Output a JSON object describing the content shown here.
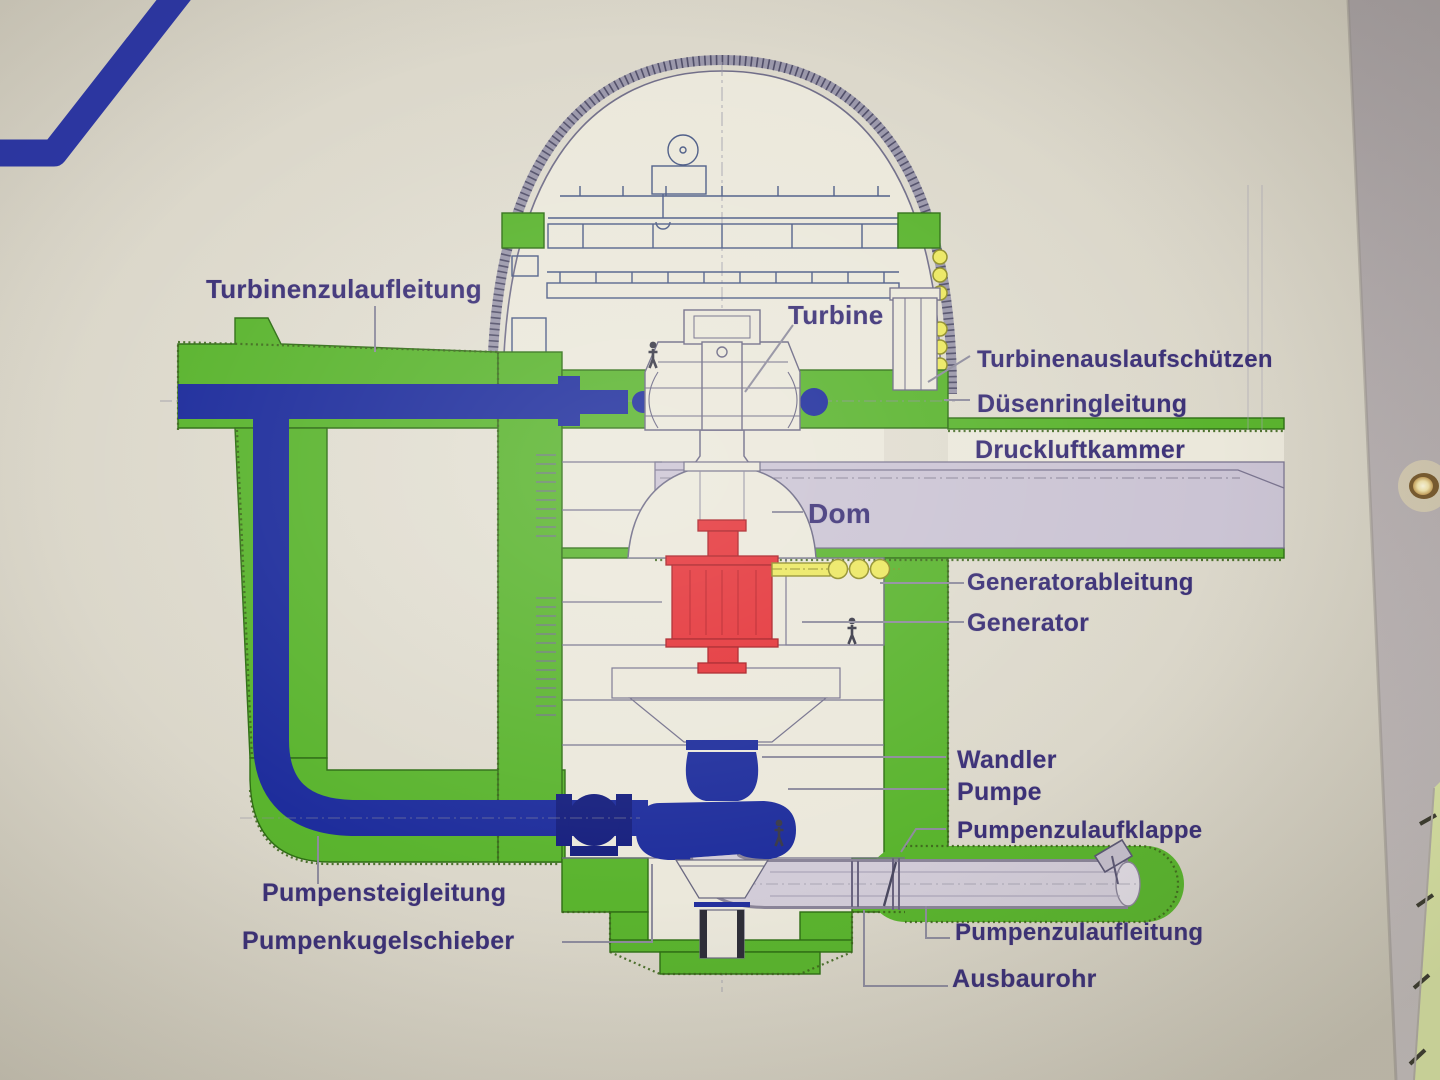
{
  "colors": {
    "wall_beige": "#d9d5c8",
    "drawing_interior": "#ebe8db",
    "concrete_green": "#5ab42e",
    "pipe_blue": "#1e2d9c",
    "wall_stripe_blue": "#2b36a6",
    "generator_red": "#e43338",
    "cable_yellow": "#ece861",
    "air_chamber_lavender": "#cbc4d4",
    "suction_pipe_gray": "#d2ccd8",
    "label_ink": "#3c3177",
    "line_ink": "#6b6884",
    "window_glow": "#dde8a8"
  },
  "labels": [
    {
      "id": "turbinenzulaufleitung",
      "text": "Turbinenzulaufleitung"
    },
    {
      "id": "turbine",
      "text": "Turbine"
    },
    {
      "id": "turbinenauslaufschuetzen",
      "text": "Turbinenauslaufschützen"
    },
    {
      "id": "duesenringleitung",
      "text": "Düsenringleitung"
    },
    {
      "id": "druckluftkammer",
      "text": "Druckluftkammer"
    },
    {
      "id": "dom",
      "text": "Dom"
    },
    {
      "id": "generatorableitung",
      "text": "Generatorableitung"
    },
    {
      "id": "generator",
      "text": "Generator"
    },
    {
      "id": "wandler",
      "text": "Wandler"
    },
    {
      "id": "pumpe",
      "text": "Pumpe"
    },
    {
      "id": "pumpenzulaufklappe",
      "text": "Pumpenzulaufklappe"
    },
    {
      "id": "pumpensteigleitung",
      "text": "Pumpensteigleitung"
    },
    {
      "id": "pumpenkugelschieber",
      "text": "Pumpenkugelschieber"
    },
    {
      "id": "pumpenzulaufleitung",
      "text": "Pumpenzulaufleitung"
    },
    {
      "id": "ausbaurohr",
      "text": "Ausbaurohr"
    }
  ],
  "photo_features": {
    "person_figures": 3,
    "wall_decor": "blue-wall-stripe",
    "right_edge": [
      "ceiling-spotlight",
      "window-glass"
    ]
  }
}
